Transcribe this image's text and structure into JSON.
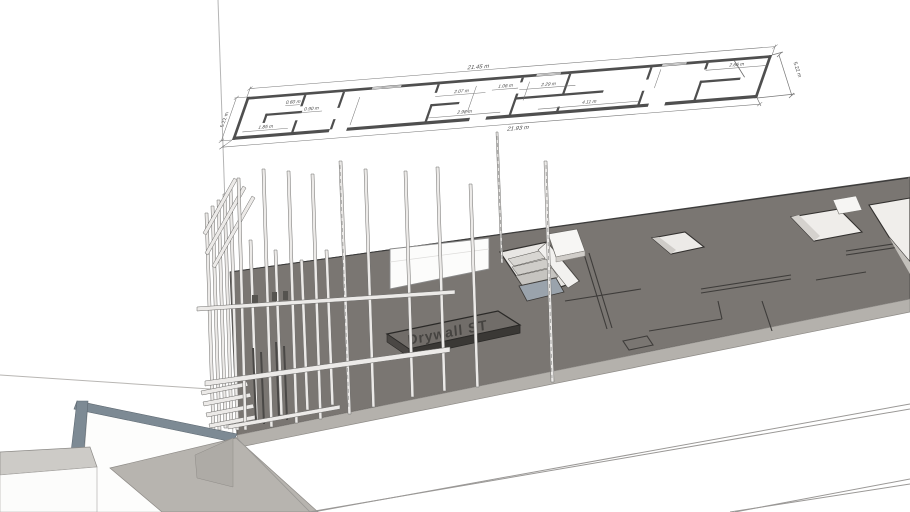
{
  "floor_plan": {
    "dim_total_top": "21.45 m",
    "dim_total_bottom": "21.93 m",
    "dim_side_left": "5.22 m",
    "dim_side_right": "5.22 m",
    "dims_top_row": [
      "2.07 m",
      "1.06 m",
      "2.29 m",
      "2.66 m"
    ],
    "dims_bottom_row": [
      "1.85 m",
      "2.98 m",
      "4.11 m"
    ],
    "dims_closet": [
      "0.60 m",
      "0.90 m"
    ]
  },
  "model": {
    "sign_label": "Drywall ST"
  },
  "colors": {
    "slab_top": "#7a7672",
    "slab_face": "#b4b1ac",
    "sign_top": "#716d69",
    "sign_face": "#3a3835",
    "parapet_band": "#7d8a94",
    "concrete": "#b7b4af",
    "stud_fill": "#eceae8",
    "stair_landing": "#9aa3ac",
    "plan_line": "#4a4a4a"
  }
}
